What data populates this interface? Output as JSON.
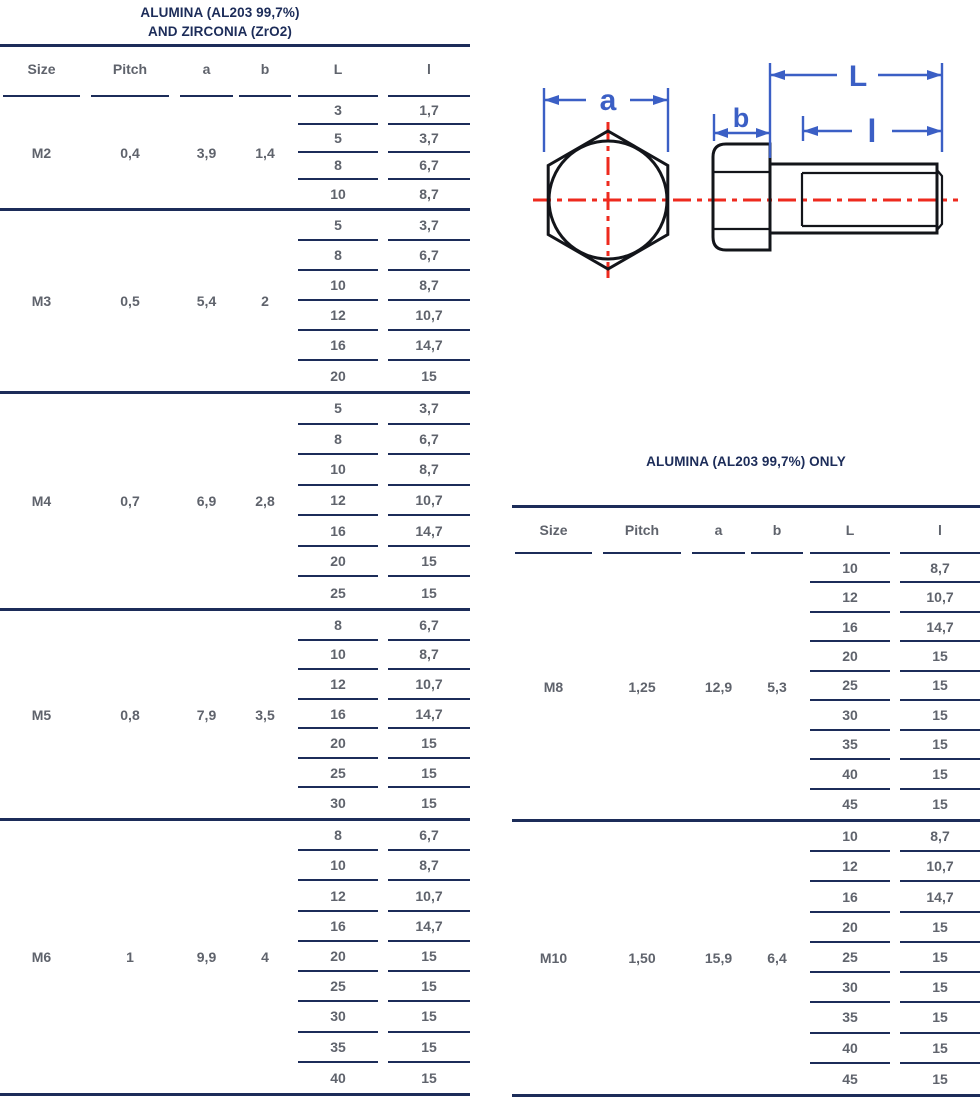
{
  "colors": {
    "navy": "#1c2c59",
    "text_gray": "#5f636c",
    "dim_blue": "#3b5fc5",
    "centerline_red": "#ee2a1e",
    "drawing_black": "#13151a"
  },
  "diagram": {
    "labels": {
      "a": "a",
      "b": "b",
      "L": "L",
      "l": "l"
    }
  },
  "tables": [
    {
      "title_lines": [
        "ALUMINA (AL203 99,7%)",
        "AND ZIRCONIA (ZrO2)"
      ],
      "columns": [
        "Size",
        "Pitch",
        "a",
        "b",
        "L",
        "l"
      ],
      "groups": [
        {
          "size": "M2",
          "pitch": "0,4",
          "a": "3,9",
          "b": "1,4",
          "rows": [
            [
              "3",
              "1,7"
            ],
            [
              "5",
              "3,7"
            ],
            [
              "8",
              "6,7"
            ],
            [
              "10",
              "8,7"
            ]
          ]
        },
        {
          "size": "M3",
          "pitch": "0,5",
          "a": "5,4",
          "b": "2",
          "rows": [
            [
              "5",
              "3,7"
            ],
            [
              "8",
              "6,7"
            ],
            [
              "10",
              "8,7"
            ],
            [
              "12",
              "10,7"
            ],
            [
              "16",
              "14,7"
            ],
            [
              "20",
              "15"
            ]
          ]
        },
        {
          "size": "M4",
          "pitch": "0,7",
          "a": "6,9",
          "b": "2,8",
          "rows": [
            [
              "5",
              "3,7"
            ],
            [
              "8",
              "6,7"
            ],
            [
              "10",
              "8,7"
            ],
            [
              "12",
              "10,7"
            ],
            [
              "16",
              "14,7"
            ],
            [
              "20",
              "15"
            ],
            [
              "25",
              "15"
            ]
          ]
        },
        {
          "size": "M5",
          "pitch": "0,8",
          "a": "7,9",
          "b": "3,5",
          "rows": [
            [
              "8",
              "6,7"
            ],
            [
              "10",
              "8,7"
            ],
            [
              "12",
              "10,7"
            ],
            [
              "16",
              "14,7"
            ],
            [
              "20",
              "15"
            ],
            [
              "25",
              "15"
            ],
            [
              "30",
              "15"
            ]
          ]
        },
        {
          "size": "M6",
          "pitch": "1",
          "a": "9,9",
          "b": "4",
          "rows": [
            [
              "8",
              "6,7"
            ],
            [
              "10",
              "8,7"
            ],
            [
              "12",
              "10,7"
            ],
            [
              "16",
              "14,7"
            ],
            [
              "20",
              "15"
            ],
            [
              "25",
              "15"
            ],
            [
              "30",
              "15"
            ],
            [
              "35",
              "15"
            ],
            [
              "40",
              "15"
            ]
          ]
        }
      ]
    },
    {
      "title_lines": [
        "ALUMINA (AL203 99,7%) ONLY"
      ],
      "columns": [
        "Size",
        "Pitch",
        "a",
        "b",
        "L",
        "l"
      ],
      "groups": [
        {
          "size": "M8",
          "pitch": "1,25",
          "a": "12,9",
          "b": "5,3",
          "rows": [
            [
              "10",
              "8,7"
            ],
            [
              "12",
              "10,7"
            ],
            [
              "16",
              "14,7"
            ],
            [
              "20",
              "15"
            ],
            [
              "25",
              "15"
            ],
            [
              "30",
              "15"
            ],
            [
              "35",
              "15"
            ],
            [
              "40",
              "15"
            ],
            [
              "45",
              "15"
            ]
          ]
        },
        {
          "size": "M10",
          "pitch": "1,50",
          "a": "15,9",
          "b": "6,4",
          "rows": [
            [
              "10",
              "8,7"
            ],
            [
              "12",
              "10,7"
            ],
            [
              "16",
              "14,7"
            ],
            [
              "20",
              "15"
            ],
            [
              "25",
              "15"
            ],
            [
              "30",
              "15"
            ],
            [
              "35",
              "15"
            ],
            [
              "40",
              "15"
            ],
            [
              "45",
              "15"
            ]
          ]
        }
      ]
    }
  ]
}
